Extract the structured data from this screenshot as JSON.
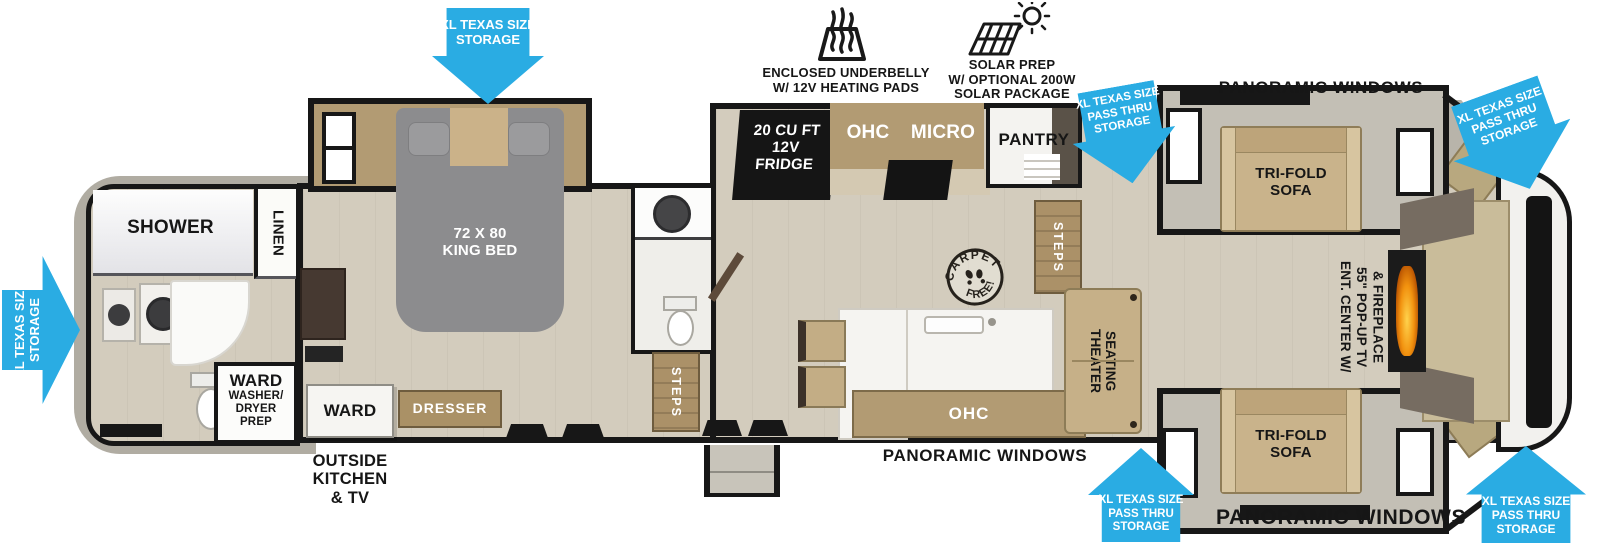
{
  "colors": {
    "arrow_blue": "#2aace3",
    "wall_black": "#171717",
    "floor_tan": "#d3ccbd",
    "cabinet_wood": "#b29b73",
    "bed_gray": "#8c8c8e",
    "flame_orange": "#f2920f"
  },
  "feature_icons": {
    "underbelly": {
      "line1": "ENCLOSED UNDERBELLY",
      "line2": "W/ 12V HEATING PADS"
    },
    "solar": {
      "line1": "SOLAR PREP",
      "line2": "W/ OPTIONAL 200W",
      "line3": "SOLAR PACKAGE"
    }
  },
  "storage": {
    "xl": {
      "line1": "XL TEXAS SIZE",
      "line2": "STORAGE"
    },
    "pass_thru": {
      "line1": "XL TEXAS SIZE",
      "line2": "PASS THRU",
      "line3": "STORAGE"
    }
  },
  "windows": {
    "top": "PANORAMIC WINDOWS",
    "bottom_mid": "PANORAMIC WINDOWS",
    "bottom_right": "PANORAMIC WINDOWS"
  },
  "front_bath": {
    "shower": "SHOWER",
    "linen": "LINEN",
    "ward_wd": {
      "line1": "WARD",
      "line2": "WASHER/",
      "line3": "DRYER",
      "line4": "PREP"
    }
  },
  "bedroom": {
    "bed": {
      "line1": "72 X 80",
      "line2": "KING BED"
    },
    "ward": "WARD",
    "dresser": "DRESSER",
    "outside_kitchen": {
      "line1": "OUTSIDE",
      "line2": "KITCHEN",
      "line3": "& TV"
    }
  },
  "kitchen": {
    "fridge": {
      "line1": "20 CU FT",
      "line2": "12V",
      "line3": "FRIDGE"
    },
    "ohc": "OHC",
    "micro": "MICRO",
    "pantry": "PANTRY",
    "ohc_lower": "OHC"
  },
  "living": {
    "theater": {
      "line1": "THEATER",
      "line2": "SEATING"
    },
    "trifold": {
      "line1": "TRI-FOLD",
      "line2": "SOFA"
    },
    "ent_center": {
      "line1": "ENT. CENTER W/",
      "line2": "55\" POP-UP TV",
      "line3": "& FIREPLACE"
    }
  },
  "misc": {
    "steps": "STEPS",
    "carpet_top": "CARPET",
    "carpet_bottom": "FREE!"
  }
}
